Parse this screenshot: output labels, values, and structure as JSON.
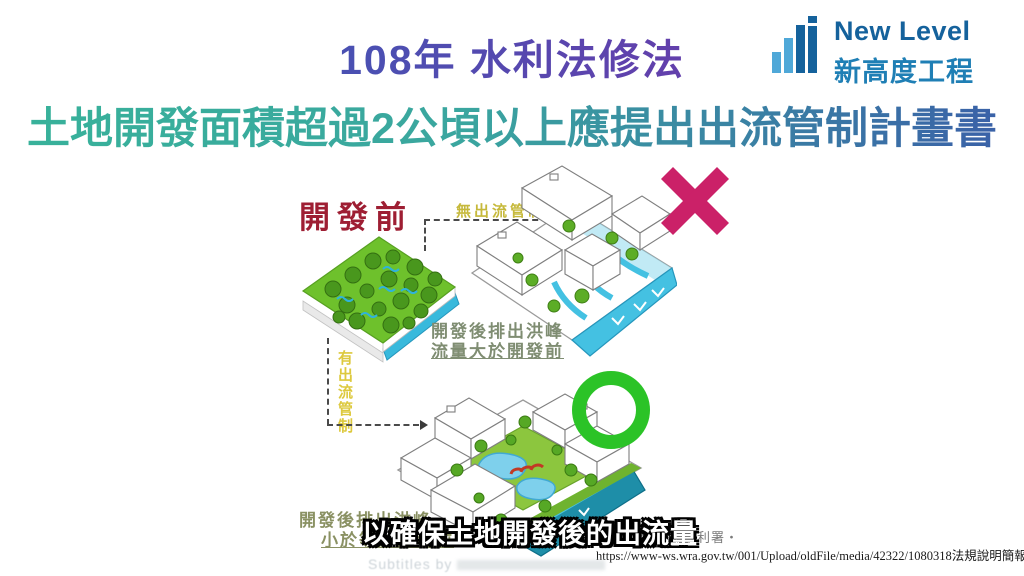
{
  "slide": {
    "title": "108年 水利法修法",
    "headline": "土地開發面積超過2公頃以上應提出出流管制計畫書",
    "subtitle": "以確保土地開發後的出流量",
    "source_org": "經濟部水利署‧",
    "source_url": "https://www-ws.wra.gov.tw/001/Upload/oldFile/media/42322/1080318法規說明簡報.pdf",
    "watermark_prefix": "Subtitles by"
  },
  "logo": {
    "name_en": "New Level",
    "name_zh": "新高度工程",
    "icon": "building-bars-icon"
  },
  "diagram": {
    "before_label": "開發前",
    "no_control_label": "無出流管制",
    "with_control_label": "有出流管制",
    "flood_line1": "開發後排出洪峰",
    "flood_line2": "流量大於開發前",
    "ok_line1": "開發後排出洪峰",
    "ok_line2": "小於等於開發前",
    "marks": {
      "wrong": "x-mark",
      "correct": "circle-mark"
    }
  },
  "colors": {
    "title_gradient": [
      "#4457B8",
      "#7D2EA5"
    ],
    "headline_gradient": [
      "#38B29A",
      "#3A5EA8"
    ],
    "before_label": "#9E1E33",
    "control_labels_yellow": "#C6B93B",
    "result_text_olive": "#7F8D72",
    "x_mark": "#CB2168",
    "o_mark": "#2BC327",
    "logo_dark_blue": "#15629C",
    "logo_light_blue": "#4FA8D8",
    "water_cyan": "#44C1E2",
    "river_teal": "#1E8EA8",
    "forest_green": "#6EC12C",
    "grass_green": "#8CC63E"
  }
}
